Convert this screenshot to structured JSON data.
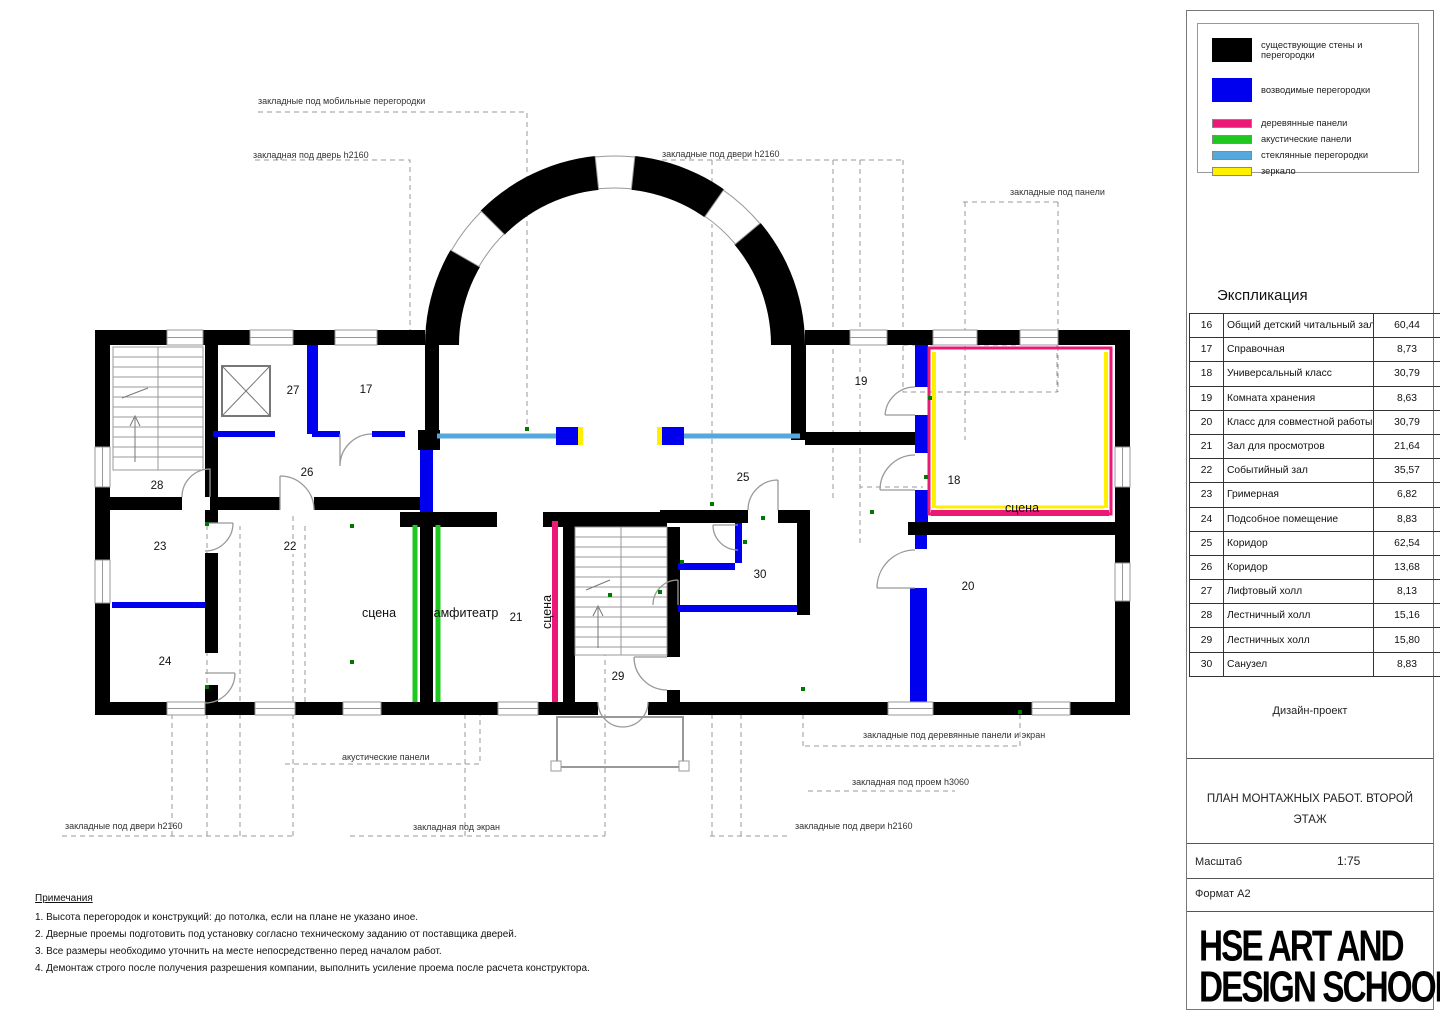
{
  "legend": {
    "items": [
      {
        "label": "существующие стены и перегородки",
        "color": "#000000",
        "type": "big"
      },
      {
        "label": "возводимые перегородки",
        "color": "#0000EE",
        "type": "big"
      },
      {
        "label": "деревянные панели",
        "color": "#EC1878",
        "type": "thin"
      },
      {
        "label": "акустические панели",
        "color": "#1EC81E",
        "type": "thin"
      },
      {
        "label": "стеклянные перегородки",
        "color": "#55A8DC",
        "type": "thin"
      },
      {
        "label": "зеркало",
        "color": "#FFF000",
        "type": "thin"
      }
    ]
  },
  "explication": {
    "title": "Экспликация",
    "rows": [
      {
        "num": "16",
        "name": "Общий детский читальный зал",
        "area": "60,44"
      },
      {
        "num": "17",
        "name": "Справочная",
        "area": "8,73"
      },
      {
        "num": "18",
        "name": "Универсальный класс",
        "area": "30,79"
      },
      {
        "num": "19",
        "name": "Комната хранения",
        "area": "8,63"
      },
      {
        "num": "20",
        "name": "Класс для совместной работы",
        "area": "30,79"
      },
      {
        "num": "21",
        "name": "Зал для просмотров",
        "area": "21,64"
      },
      {
        "num": "22",
        "name": "Событийный зал",
        "area": "35,57"
      },
      {
        "num": "23",
        "name": "Гримерная",
        "area": "6,82"
      },
      {
        "num": "24",
        "name": "Подсобное помещение",
        "area": "8,83"
      },
      {
        "num": "25",
        "name": "Коридор",
        "area": "62,54"
      },
      {
        "num": "26",
        "name": "Коридор",
        "area": "13,68"
      },
      {
        "num": "27",
        "name": "Лифтовый холл",
        "area": "8,13"
      },
      {
        "num": "28",
        "name": "Лестничный холл",
        "area": "15,16"
      },
      {
        "num": "29",
        "name": "Лестничных холл",
        "area": "15,80"
      },
      {
        "num": "30",
        "name": "Санузел",
        "area": "8,83"
      }
    ]
  },
  "titleblock": {
    "project_type": "Дизайн-проект",
    "sheet_title": "ПЛАН МОНТАЖНЫХ РАБОТ. ВТОРОЙ ЭТАЖ",
    "scale_label": "Масштаб",
    "scale_value": "1:75",
    "format_label": "Формат А2",
    "logo_line1": "HSE ART AND",
    "logo_line2": "DESIGN SCHOOL",
    "logo_mark": "В"
  },
  "notes": {
    "title": "Примечания",
    "items": [
      "1. Высота перегородок и конструкций: до потолка, если на плане не указано иное.",
      "2. Дверные проемы подготовить под установку согласно техническому заданию от поставщика дверей.",
      "3. Все размеры необходимо уточнить на месте непосредственно перед началом работ.",
      "4. Демонтаж строго после получения разрешения компании, выполнить усиление проема после расчета конструктора."
    ]
  },
  "plan": {
    "room_numbers": [
      {
        "n": "17",
        "x": 366,
        "y": 390
      },
      {
        "n": "18",
        "x": 954,
        "y": 481
      },
      {
        "n": "19",
        "x": 861,
        "y": 382
      },
      {
        "n": "20",
        "x": 968,
        "y": 587
      },
      {
        "n": "21",
        "x": 516,
        "y": 618
      },
      {
        "n": "22",
        "x": 290,
        "y": 547
      },
      {
        "n": "23",
        "x": 160,
        "y": 547
      },
      {
        "n": "24",
        "x": 165,
        "y": 662
      },
      {
        "n": "25",
        "x": 743,
        "y": 478
      },
      {
        "n": "26",
        "x": 307,
        "y": 473
      },
      {
        "n": "27",
        "x": 293,
        "y": 391
      },
      {
        "n": "28",
        "x": 157,
        "y": 486
      },
      {
        "n": "29",
        "x": 618,
        "y": 677
      },
      {
        "n": "30",
        "x": 760,
        "y": 575
      }
    ],
    "room_texts": [
      {
        "t": "сцена",
        "x": 379,
        "y": 613,
        "rot": false
      },
      {
        "t": "амфитеатр",
        "x": 466,
        "y": 613,
        "rot": false
      },
      {
        "t": "сцена",
        "x": 547,
        "y": 612,
        "rot": true
      },
      {
        "t": "сцена",
        "x": 1022,
        "y": 508,
        "rot": false
      }
    ],
    "annotations": [
      {
        "t": "закладные под мобильные перегородки",
        "x": 258,
        "y": 96
      },
      {
        "t": "закладная под дверь h2160",
        "x": 253,
        "y": 150
      },
      {
        "t": "закладные под двери h2160",
        "x": 662,
        "y": 149
      },
      {
        "t": "закладные под панели",
        "x": 1010,
        "y": 187
      },
      {
        "t": "акустические панели",
        "x": 342,
        "y": 752
      },
      {
        "t": "закладная под экран",
        "x": 413,
        "y": 822
      },
      {
        "t": "закладные под двери h2160",
        "x": 65,
        "y": 821
      },
      {
        "t": "закладные под деревянные панели и экран",
        "x": 863,
        "y": 730
      },
      {
        "t": "закладная под проем h3060",
        "x": 852,
        "y": 777
      },
      {
        "t": "закладные под двери h2160",
        "x": 795,
        "y": 821
      }
    ]
  }
}
